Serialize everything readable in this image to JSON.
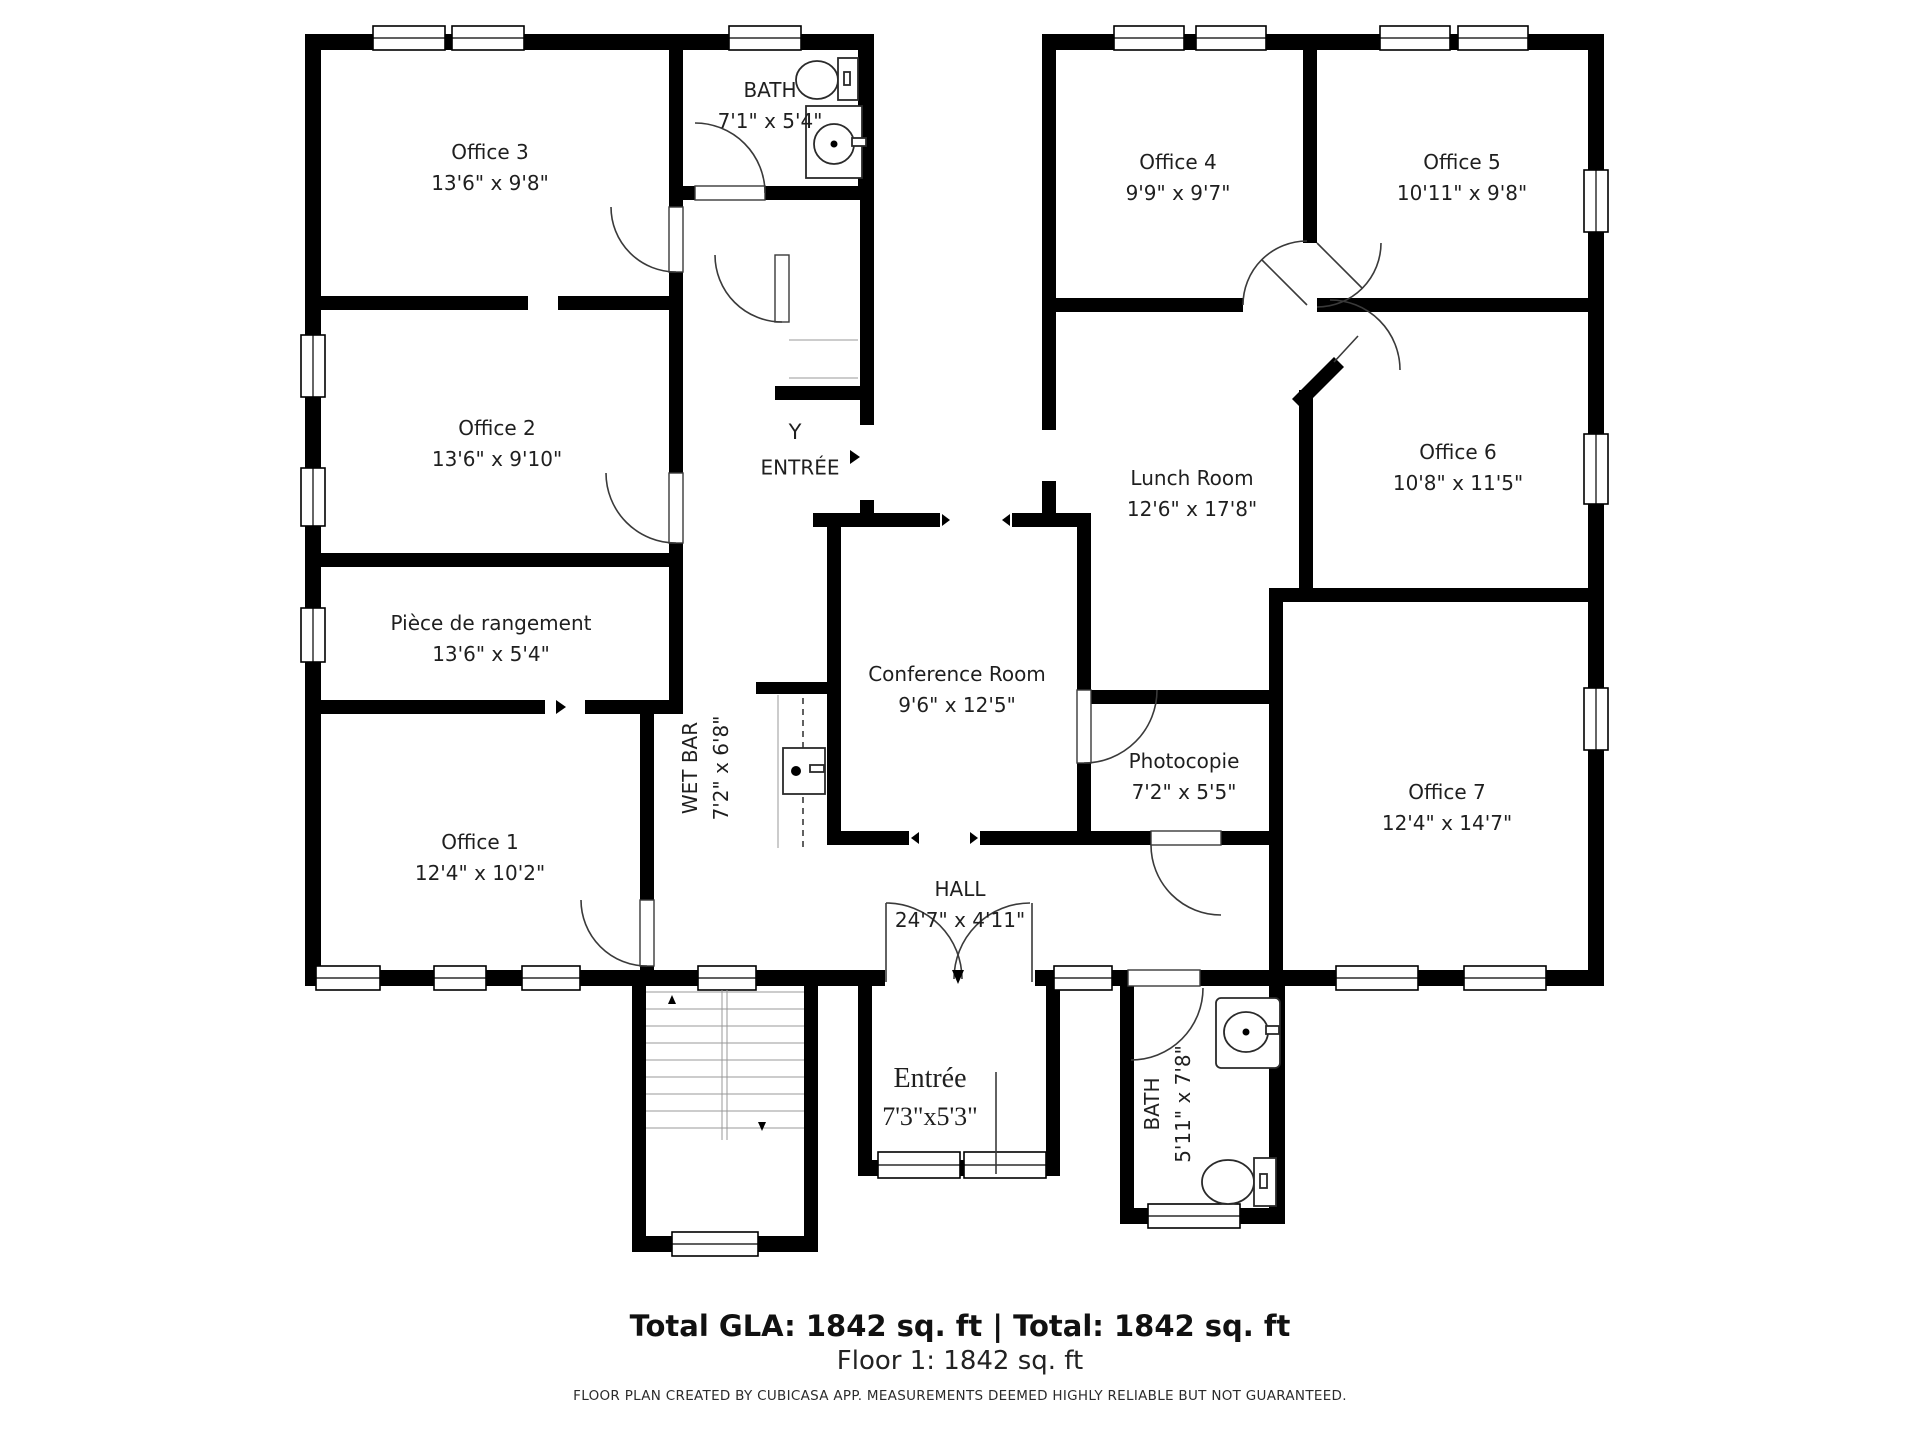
{
  "title": "Floor 1 floor plan",
  "theme": {
    "wall_color": "#000000",
    "text_color": "#1f1f1f",
    "line_color": "#3a3a3a"
  },
  "rooms": {
    "office3": {
      "label": "Office 3",
      "dims": "13'6\" x 9'8\""
    },
    "bath_top": {
      "label": "BATH",
      "dims": "7'1\" x 5'4\""
    },
    "office4": {
      "label": "Office 4",
      "dims": "9'9\" x 9'7\""
    },
    "office5": {
      "label": "Office 5",
      "dims": "10'11\" x 9'8\""
    },
    "office2": {
      "label": "Office 2",
      "dims": "13'6\" x 9'10\""
    },
    "entree_mid": {
      "marker": "Y",
      "label": "ENTRÉE"
    },
    "lunch": {
      "label": "Lunch Room",
      "dims": "12'6\" x 17'8\""
    },
    "office6": {
      "label": "Office 6",
      "dims": "10'8\" x 11'5\""
    },
    "rangement": {
      "label": "Pièce de rangement",
      "dims": "13'6\" x 5'4\""
    },
    "conference": {
      "label": "Conference Room",
      "dims": "9'6\" x 12'5\""
    },
    "wetbar": {
      "label": "WET BAR",
      "dims": "7'2\" x 6'8\""
    },
    "photocopie": {
      "label": "Photocopie",
      "dims": "7'2\" x 5'5\""
    },
    "office1": {
      "label": "Office 1",
      "dims": "12'4\" x 10'2\""
    },
    "office7": {
      "label": "Office 7",
      "dims": "12'4\" x 14'7\""
    },
    "hall": {
      "label": "HALL",
      "dims": "24'7\" x 4'11\""
    },
    "entree_bottom": {
      "label": "Entrée",
      "dims": "7'3\"x5'3\""
    },
    "bath_bottom": {
      "label": "BATH",
      "dims": "5'11\" x 7'8\""
    }
  },
  "summary": {
    "total_line": "Total GLA: 1842 sq. ft | Total: 1842 sq. ft",
    "floor_line": "Floor 1: 1842 sq. ft"
  },
  "footer": "FLOOR PLAN CREATED BY CUBICASA APP. MEASUREMENTS DEEMED HIGHLY RELIABLE BUT NOT GUARANTEED."
}
